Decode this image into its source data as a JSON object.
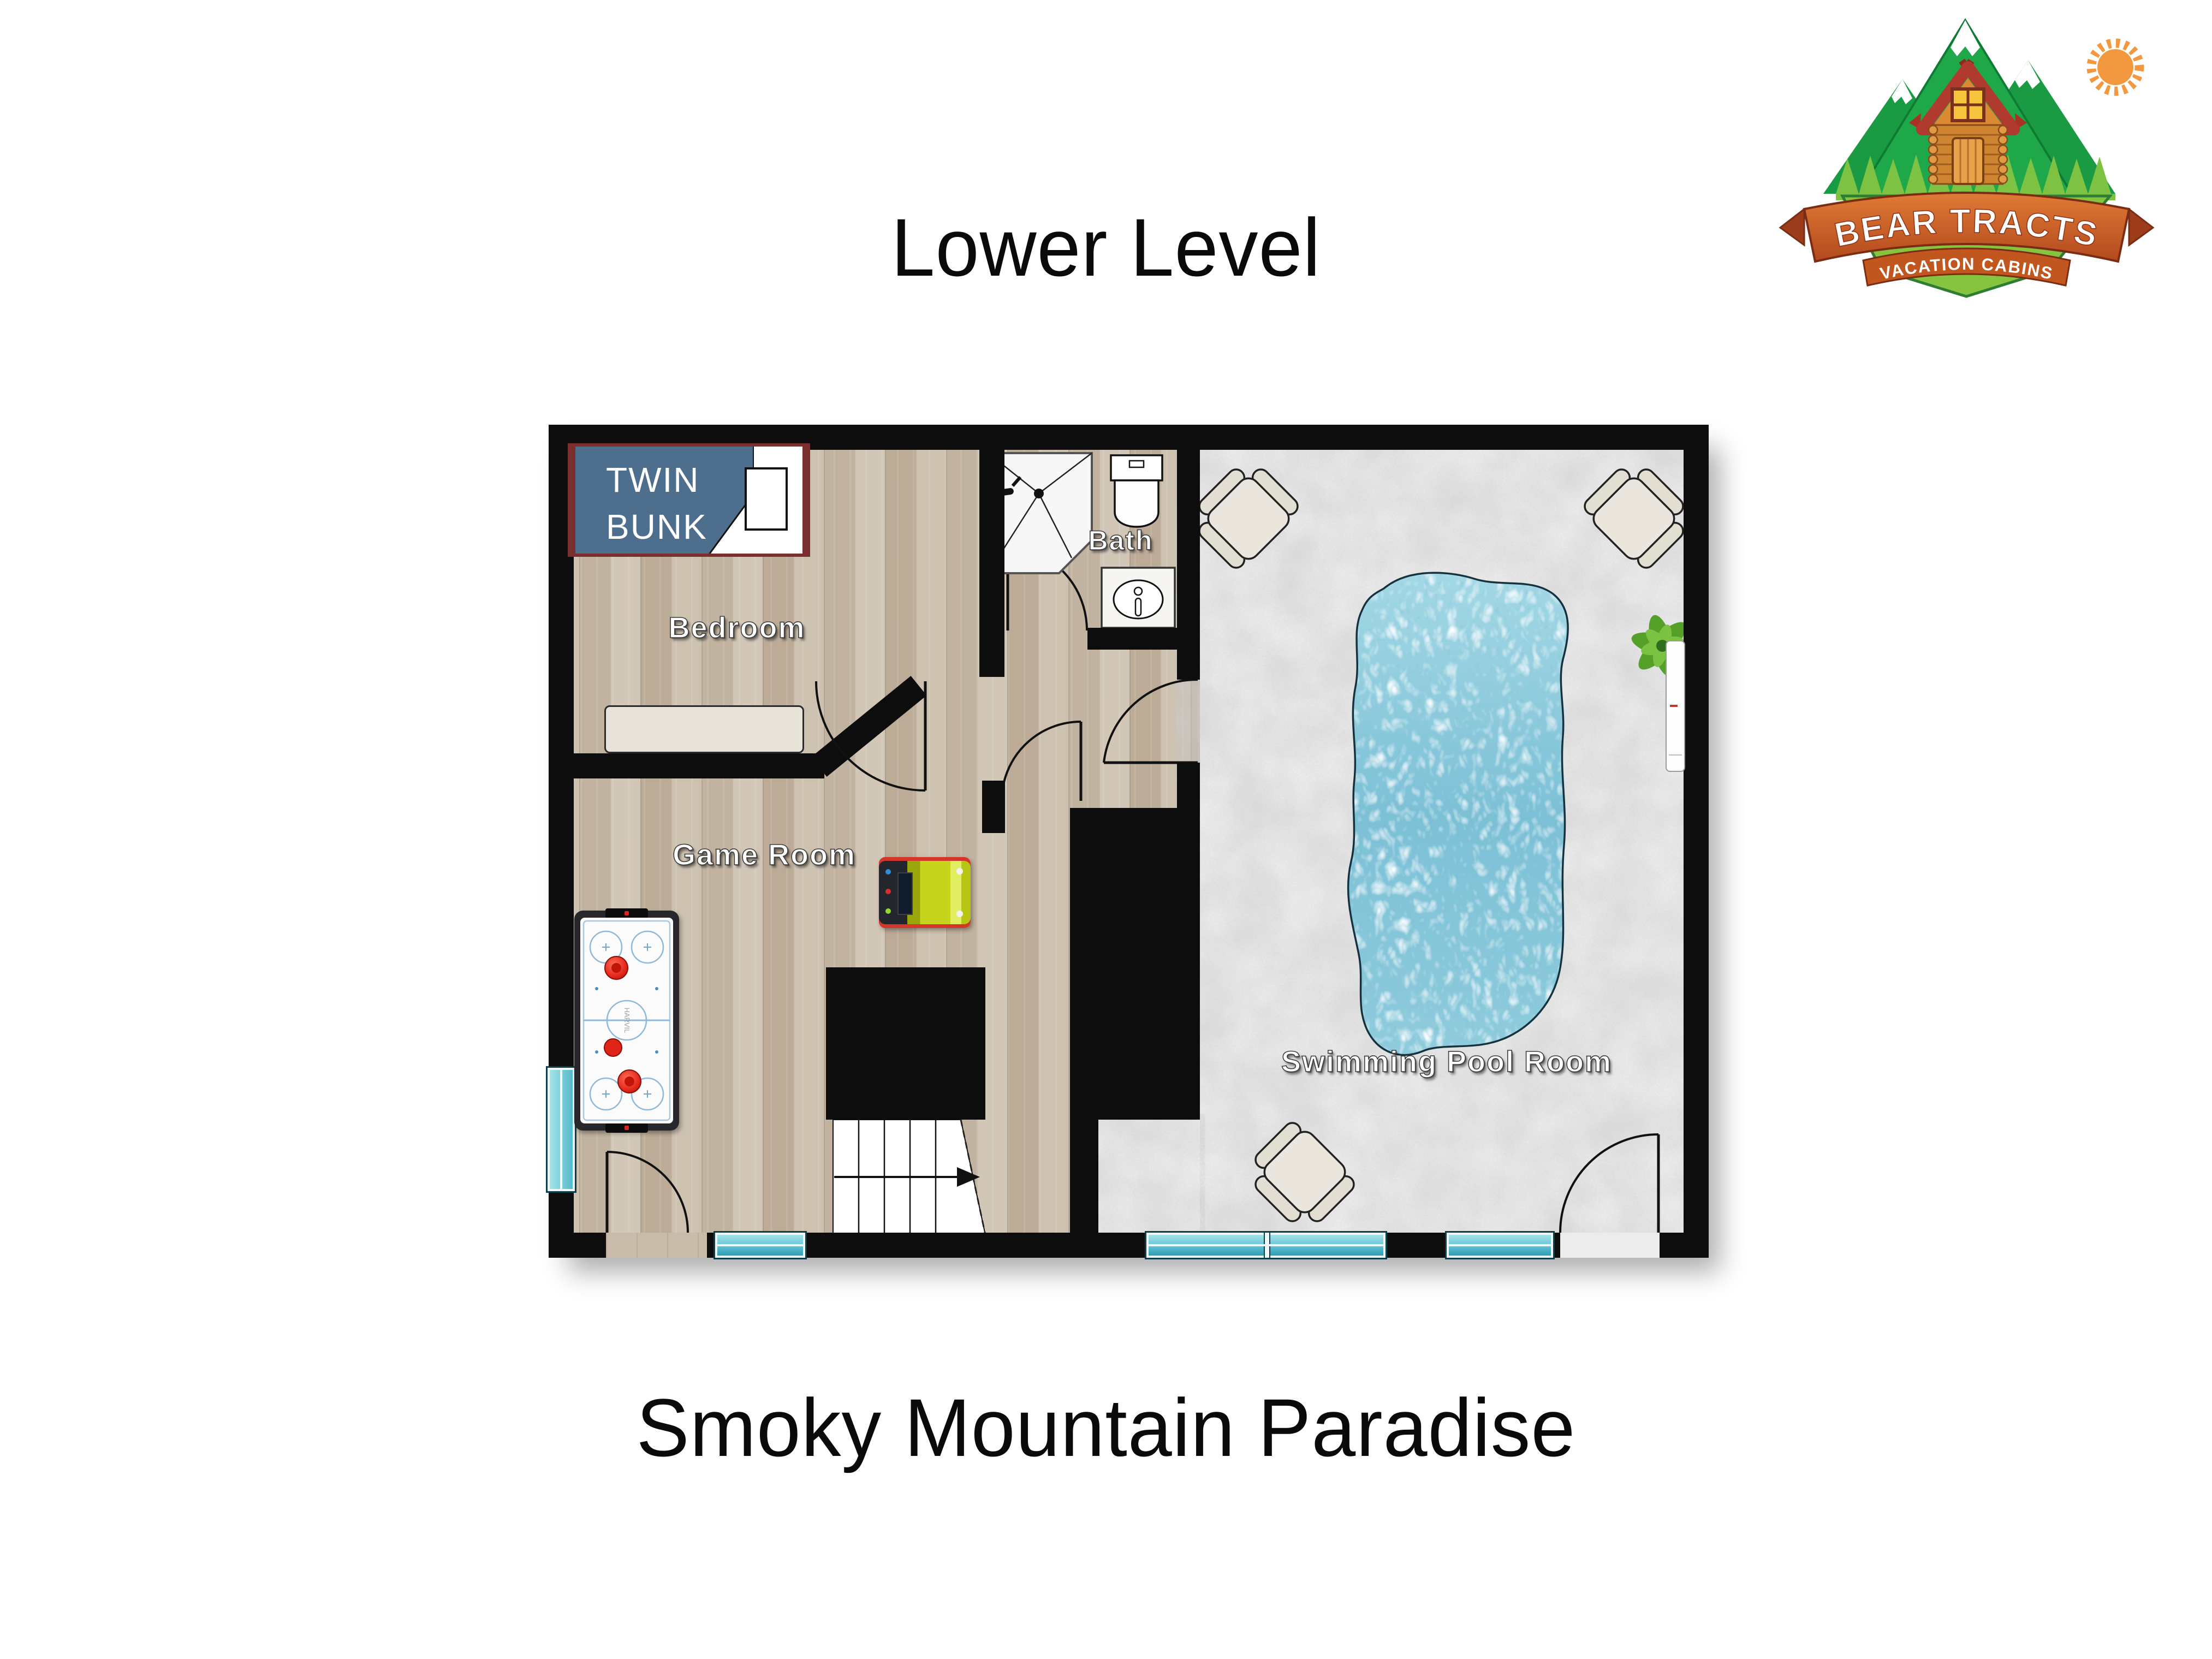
{
  "header": {
    "title": "Lower Level"
  },
  "footer": {
    "title": "Smoky Mountain Paradise"
  },
  "logo": {
    "name": "BEAR TRACTS",
    "tagline": "VACATION CABINS"
  },
  "plan": {
    "rooms": {
      "bedroom": {
        "label": "Bedroom"
      },
      "bath": {
        "label": "Bath"
      },
      "game_room": {
        "label": "Game Room"
      },
      "pool_room": {
        "label": "Swimming Pool Room"
      }
    },
    "furniture": {
      "bed_label": "TWIN\nBUNK"
    },
    "stairs": {
      "direction": "right"
    },
    "colors": {
      "wall": "#0d0d0d",
      "wood_floor": "#c8bbaa",
      "concrete_floor": "#ececec",
      "pool_water": "#8ccfe0",
      "window_glass": "#5ac8da",
      "bed_blanket": "#4e6e8e",
      "bed_frame": "#7a2e2e",
      "arcade_yellow": "#c7d41c",
      "arcade_red": "#d4372a",
      "logo_light_green": "#7dc242",
      "logo_dark_green": "#199a43",
      "logo_orange": "#d96b2f",
      "logo_sun": "#f2993f"
    }
  }
}
